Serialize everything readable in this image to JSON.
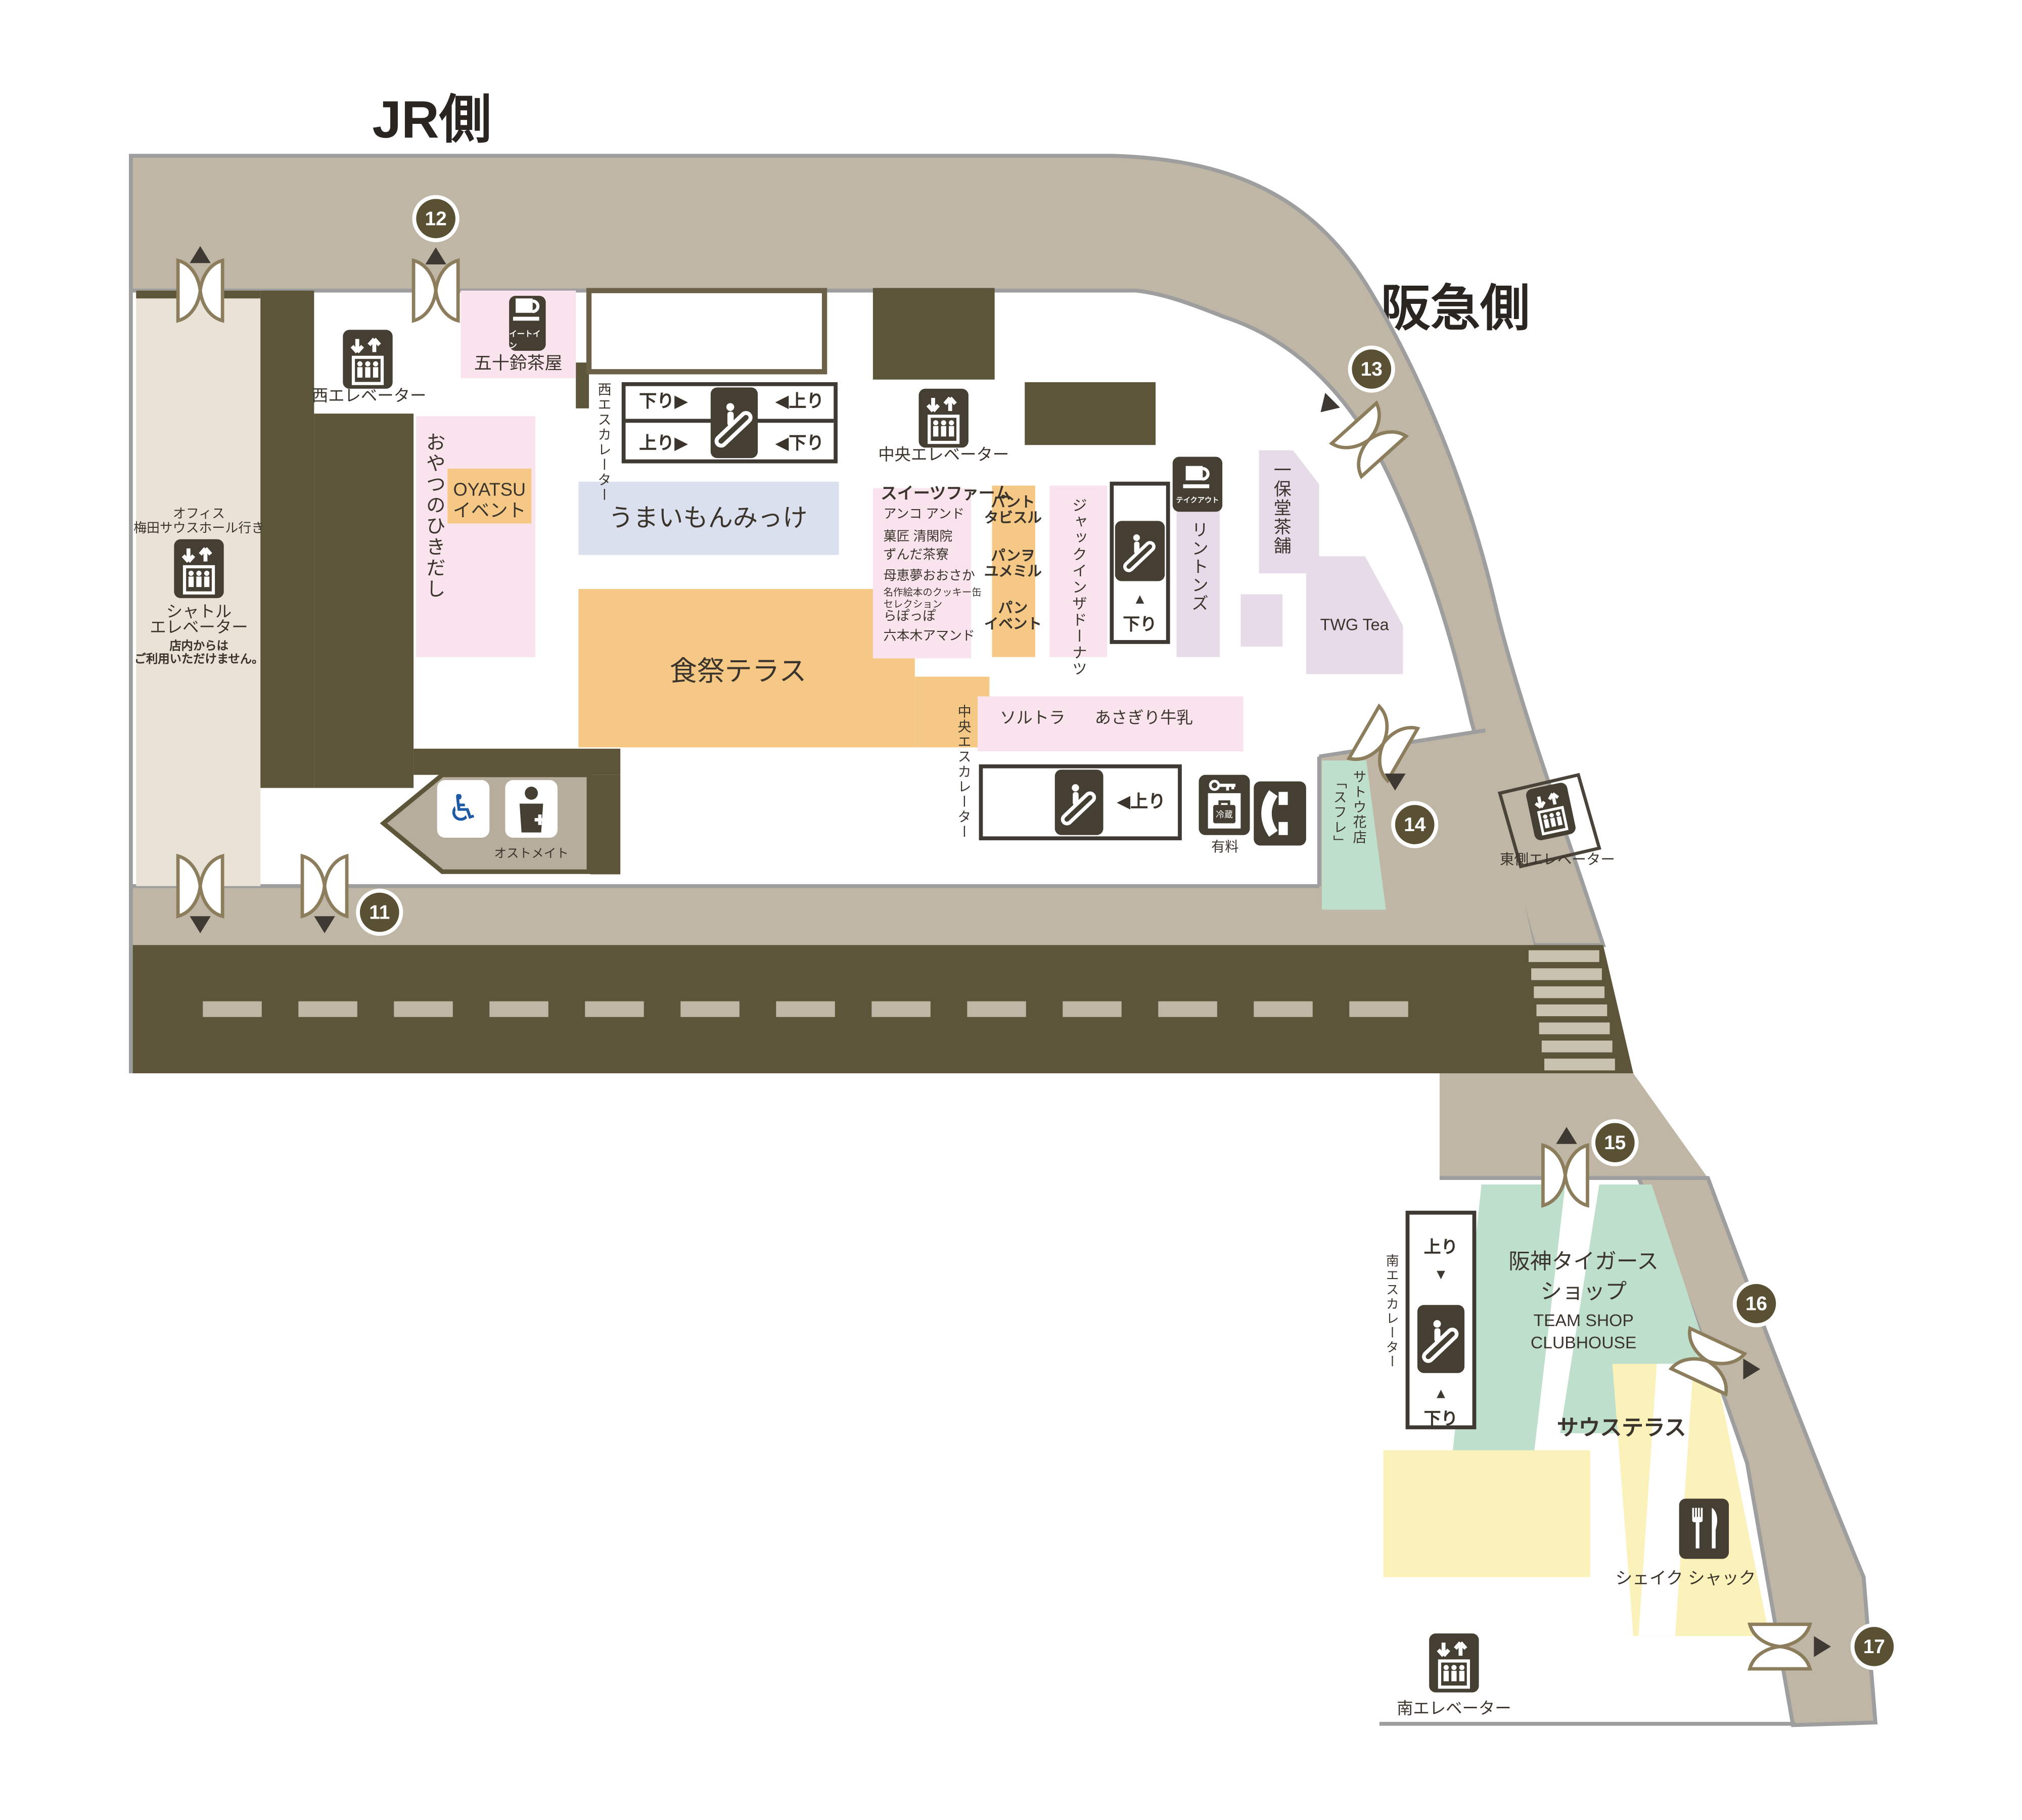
{
  "titles": {
    "jr": "JR側",
    "hankyu": "阪急側"
  },
  "entrances": {
    "n11": "11",
    "n12": "12",
    "n13": "13",
    "n14": "14",
    "n15": "15",
    "n16": "16",
    "n17": "17"
  },
  "elevators": {
    "west": "西エレベーター",
    "central": "中央エレベーター",
    "east": "東側エレベーター",
    "south": "南エレベーター",
    "shuttle_dest1": "オフィス",
    "shuttle_dest2": "梅田サウスホール行き",
    "shuttle_name1": "シャトル",
    "shuttle_name2": "エレベーター",
    "shuttle_note1": "店内からは",
    "shuttle_note2": "ご利用いただけません。"
  },
  "escalators": {
    "west": "西エスカレーター",
    "central": "中央エスカレーター",
    "south": "南エスカレーター",
    "west_r1_left": "下り▶",
    "west_r1_right": "◀上り",
    "west_r2_left": "上り▶",
    "west_r2_right": "◀下り",
    "central_up": "◀上り",
    "up": "上り",
    "down": "下り",
    "arrow_up": "▲",
    "arrow_down": "▼"
  },
  "shops": {
    "isuzu": "五十鈴茶屋",
    "oyatsu": "おやつのひきだし",
    "oyatsu_event1": "OYATSU",
    "oyatsu_event2": "イベント",
    "umaimon": "うまいもんみっけ",
    "shokusai": "食祭テラス",
    "sweets": {
      "title": "スイーツファーム",
      "items": [
        "アンコ アンド",
        "菓匠 清閑院",
        "ずんだ茶寮",
        "母恵夢おおさか",
        "名作絵本のクッキー缶",
        "セレクション",
        "らぽっぽ",
        "六本木アマンド"
      ]
    },
    "bread": [
      "パント",
      "タビスル",
      "パンヲ",
      "ユメミル",
      "パン",
      "イベント"
    ],
    "jack": "ジャックインザドーナツ",
    "rintons": "リントンズ",
    "ippodo": "一保堂茶舗",
    "twg": "TWG Tea",
    "soltra": "ソルトラ",
    "asagiri": "あさぎり牛乳",
    "sato1": "サトウ花店",
    "sato2": "「スフレ」",
    "tigers1": "阪神タイガース",
    "tigers2": "ショップ",
    "tigers3": "TEAM SHOP",
    "tigers4": "CLUBHOUSE",
    "south_terrace": "サウステラス",
    "shake": "シェイク シャック"
  },
  "facilities": {
    "eat_in": "イートイン",
    "takeout": "テイクアウト",
    "ostomate": "オストメイト",
    "paid": "有料",
    "cold": "冷蔵"
  },
  "colors": {
    "band": "#bfb6a5",
    "road": "#5d5539",
    "dark_box": "#453e33",
    "pink": "#f9e3ec",
    "lavender": "#e7dbe9",
    "orange": "#f6c885",
    "blue_gray": "#dbe0ee",
    "green": "#bfdfcd",
    "yellow": "#fbf1bb",
    "beige": "#e8e3d6",
    "badge": "#5a5134",
    "wheelchair_blue": "#1d5ba4"
  }
}
